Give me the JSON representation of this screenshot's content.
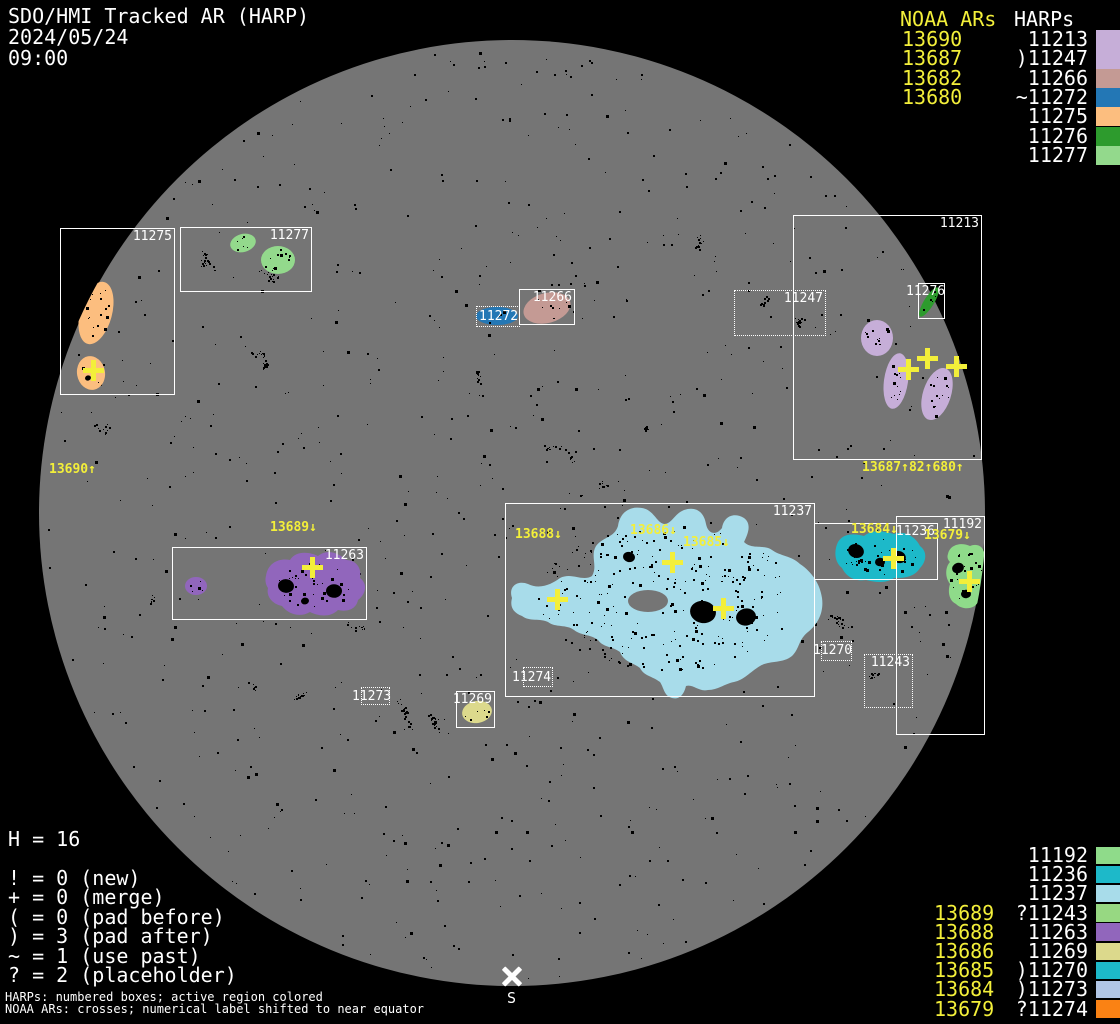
{
  "header": {
    "title": "SDO/HMI Tracked AR (HARP)",
    "date": "2024/05/24",
    "time": "09:00"
  },
  "colors": {
    "background": "#000000",
    "disk": "#757575",
    "box_stroke": "#ffffff",
    "noaa_yellow": "#f3ef3a",
    "speckle": "#000000"
  },
  "legend_top_right": {
    "noaa_header": "NOAA ARs",
    "harp_header": "HARPs",
    "rows": [
      {
        "noaa": "13690",
        "prefix": "",
        "harp": "11213",
        "color": "#c6aed8"
      },
      {
        "noaa": "13687",
        "prefix": ")",
        "harp": "11247",
        "color": "#c6aed8"
      },
      {
        "noaa": "13682",
        "prefix": "",
        "harp": "11266",
        "color": "#c49a94"
      },
      {
        "noaa": "13680",
        "prefix": "~",
        "harp": "11272",
        "color": "#2377b5"
      },
      {
        "noaa": "",
        "prefix": "",
        "harp": "11275",
        "color": "#fcbe7f"
      },
      {
        "noaa": "",
        "prefix": "",
        "harp": "11276",
        "color": "#2d9b2d"
      },
      {
        "noaa": "",
        "prefix": "",
        "harp": "11277",
        "color": "#93d98c"
      }
    ]
  },
  "legend_bottom_right": {
    "rows": [
      {
        "noaa": "",
        "prefix": "",
        "harp": "11192",
        "color": "#8fdb8a"
      },
      {
        "noaa": "",
        "prefix": "",
        "harp": "11236",
        "color": "#1db9c9"
      },
      {
        "noaa": "",
        "prefix": "",
        "harp": "11237",
        "color": "#a8dcea"
      },
      {
        "noaa": "13689",
        "prefix": "?",
        "harp": "11243",
        "color": "#97d882"
      },
      {
        "noaa": "13688",
        "prefix": "",
        "harp": "11263",
        "color": "#9166bc"
      },
      {
        "noaa": "13686",
        "prefix": "",
        "harp": "11269",
        "color": "#dcd98c"
      },
      {
        "noaa": "13685",
        "prefix": ")",
        "harp": "11270",
        "color": "#1db9c9"
      },
      {
        "noaa": "13684",
        "prefix": ")",
        "harp": "11273",
        "color": "#b1c6e6"
      },
      {
        "noaa": "13679",
        "prefix": "?",
        "harp": "11274",
        "color": "#fa8214"
      }
    ]
  },
  "legend_bottom_left": {
    "harp_count": "H = 16",
    "lines": [
      "! = 0 (new)",
      "+ = 0 (merge)",
      "( = 0 (pad before)",
      ") = 3 (pad after)",
      "~ = 1 (use past)",
      "? = 2 (placeholder)"
    ],
    "note1": "HARPs: numbered boxes; active region colored",
    "note2": "NOAA ARs: crosses; numerical label shifted to near equator"
  },
  "south_marker": {
    "label": "S",
    "x": 512,
    "y": 976
  },
  "disk": {
    "cx": 512,
    "cy": 513,
    "r": 473
  },
  "harp_boxes": [
    {
      "label": "11275",
      "x": 60,
      "y": 228,
      "w": 115,
      "h": 167,
      "style": "solid"
    },
    {
      "label": "11277",
      "x": 180,
      "y": 227,
      "w": 132,
      "h": 65,
      "style": "solid"
    },
    {
      "label": "11266",
      "x": 519,
      "y": 289,
      "w": 56,
      "h": 36,
      "style": "solid"
    },
    {
      "label": "11272",
      "x": 476,
      "y": 306,
      "w": 44,
      "h": 21,
      "style": "dotted",
      "lx": 479,
      "ly": 310
    },
    {
      "label": "11247",
      "x": 734,
      "y": 290,
      "w": 92,
      "h": 46,
      "style": "dotted"
    },
    {
      "label": "11213",
      "x": 793,
      "y": 215,
      "w": 189,
      "h": 245,
      "style": "solid"
    },
    {
      "label": "11276",
      "x": 918,
      "y": 283,
      "w": 27,
      "h": 36,
      "style": "solid",
      "lx": 906,
      "ly": 285
    },
    {
      "label": "11263",
      "x": 172,
      "y": 547,
      "w": 195,
      "h": 73,
      "style": "solid"
    },
    {
      "label": "11237",
      "x": 505,
      "y": 503,
      "w": 310,
      "h": 194,
      "style": "solid"
    },
    {
      "label": "11274",
      "x": 523,
      "y": 667,
      "w": 30,
      "h": 20,
      "style": "dotted",
      "lx": 512,
      "ly": 671
    },
    {
      "label": "11273",
      "x": 361,
      "y": 687,
      "w": 29,
      "h": 18,
      "style": "dotted",
      "lx": 352,
      "ly": 690
    },
    {
      "label": "11269",
      "x": 456,
      "y": 691,
      "w": 39,
      "h": 37,
      "style": "solid"
    },
    {
      "label": "11236",
      "x": 814,
      "y": 523,
      "w": 124,
      "h": 57,
      "style": "solid"
    },
    {
      "label": "11192",
      "x": 896,
      "y": 516,
      "w": 89,
      "h": 219,
      "style": "solid"
    },
    {
      "label": "11270",
      "x": 821,
      "y": 641,
      "w": 31,
      "h": 20,
      "style": "dotted",
      "lx": 813,
      "ly": 644
    },
    {
      "label": "11243",
      "x": 864,
      "y": 654,
      "w": 49,
      "h": 54,
      "style": "dotted"
    }
  ],
  "noaa_disk_labels": [
    {
      "text": "13690↑",
      "x": 49,
      "y": 463
    },
    {
      "text": "13687↑82↑680↑",
      "x": 862,
      "y": 461
    },
    {
      "text": "13689↓",
      "x": 270,
      "y": 521
    },
    {
      "text": "13688↓",
      "x": 515,
      "y": 528
    },
    {
      "text": "13686↓",
      "x": 630,
      "y": 524
    },
    {
      "text": "13685↓",
      "x": 683,
      "y": 536
    },
    {
      "text": "13684↓",
      "x": 851,
      "y": 523
    },
    {
      "text": "13679↓",
      "x": 924,
      "y": 529
    }
  ],
  "crosses": [
    {
      "x": 93,
      "y": 370
    },
    {
      "x": 908,
      "y": 369
    },
    {
      "x": 927,
      "y": 358
    },
    {
      "x": 956,
      "y": 366
    },
    {
      "x": 312,
      "y": 567
    },
    {
      "x": 557,
      "y": 599
    },
    {
      "x": 672,
      "y": 562
    },
    {
      "x": 723,
      "y": 608
    },
    {
      "x": 893,
      "y": 558
    },
    {
      "x": 969,
      "y": 581
    }
  ],
  "regions": [
    {
      "harp": "11275",
      "color": "#fcbe7f",
      "shape": "ellipse",
      "cx": 96,
      "cy": 313,
      "rx": 16,
      "ry": 32,
      "rot": 15,
      "speckles": 16
    },
    {
      "harp": "11275",
      "color": "#fcbe7f",
      "shape": "ellipse",
      "cx": 91,
      "cy": 373,
      "rx": 14,
      "ry": 17,
      "rot": -10,
      "speckles": 4
    },
    {
      "harp": "11277",
      "color": "#93d98c",
      "shape": "ellipse",
      "cx": 243,
      "cy": 243,
      "rx": 13,
      "ry": 9,
      "rot": -15,
      "speckles": 6
    },
    {
      "harp": "11277",
      "color": "#93d98c",
      "shape": "ellipse",
      "cx": 278,
      "cy": 260,
      "rx": 17,
      "ry": 14,
      "rot": 0,
      "speckles": 12
    },
    {
      "harp": "11266",
      "color": "#c49a94",
      "shape": "ellipse",
      "cx": 547,
      "cy": 308,
      "rx": 24,
      "ry": 15,
      "rot": -15,
      "speckles": 10
    },
    {
      "harp": "11272",
      "color": "#2377b5",
      "shape": "ellipse",
      "cx": 497,
      "cy": 316,
      "rx": 21,
      "ry": 9,
      "rot": 0,
      "speckles": 4
    },
    {
      "harp": "11276",
      "color": "#2d9b2d",
      "shape": "ellipse",
      "cx": 929,
      "cy": 302,
      "rx": 5,
      "ry": 17,
      "rot": 32,
      "speckles": 6,
      "clip": false
    },
    {
      "harp": "11213",
      "color": "#c6aed8",
      "shape": "ellipse",
      "cx": 877,
      "cy": 338,
      "rx": 16,
      "ry": 18,
      "rot": 0,
      "speckles": 12
    },
    {
      "harp": "11213",
      "color": "#c6aed8",
      "shape": "ellipse",
      "cx": 896,
      "cy": 381,
      "rx": 12,
      "ry": 28,
      "rot": 8,
      "speckles": 14
    },
    {
      "harp": "11213",
      "color": "#c6aed8",
      "shape": "ellipse",
      "cx": 937,
      "cy": 394,
      "rx": 14,
      "ry": 27,
      "rot": 18,
      "speckles": 14
    },
    {
      "harp": "11263",
      "color": "#9166bc",
      "shape": "ellipse",
      "cx": 196,
      "cy": 586,
      "rx": 11,
      "ry": 9,
      "rot": 0,
      "speckles": 5
    },
    {
      "harp": "11263",
      "color": "#9166bc",
      "shape": "path",
      "d": "M 266 576 C 268 562 280 558 290 560 C 296 550 310 552 318 556 C 328 548 340 554 346 560 C 356 560 362 568 360 578 C 368 584 366 594 358 600 C 356 610 346 612 338 610 C 330 618 318 616 310 612 C 300 618 288 614 282 606 C 272 604 266 596 268 588 C 264 582 266 576 266 576 Z",
      "cx": 312,
      "cy": 584,
      "rx": 44,
      "ry": 26,
      "speckles": 42
    },
    {
      "harp": "11237",
      "color": "#a8dcea",
      "shape": "path",
      "d": "M 512 598 C 508 586 518 580 528 584 C 540 590 552 584 560 578 C 572 572 582 582 592 576 C 598 566 590 556 596 546 C 604 536 614 538 618 526 C 620 512 630 506 642 508 C 654 510 656 522 664 524 C 672 524 674 514 684 510 C 696 506 704 512 706 524 C 708 534 716 536 722 528 C 724 516 734 512 744 518 C 752 524 748 534 744 542 C 752 550 764 544 772 550 C 780 556 792 556 800 564 C 812 572 820 584 822 598 C 824 612 818 624 808 632 C 798 640 800 648 792 656 C 782 664 770 660 760 666 C 750 672 744 680 734 682 C 724 684 718 690 708 690 C 698 692 694 684 686 686 C 684 694 680 700 672 698 C 664 696 664 688 660 682 C 652 676 644 676 640 668 C 632 662 624 662 620 652 C 612 646 604 648 598 640 C 590 634 582 636 574 630 C 566 624 556 628 548 622 C 540 618 530 622 522 616 C 512 612 510 606 512 598 Z",
      "cx": 667,
      "cy": 598,
      "rx": 148,
      "ry": 82,
      "speckles": 300,
      "hole": {
        "cx": 648,
        "cy": 601,
        "rx": 20,
        "ry": 11
      }
    },
    {
      "harp": "11236",
      "color": "#1db9c9",
      "shape": "path",
      "d": "M 838 542 C 844 532 856 534 864 536 C 874 528 886 532 894 534 C 906 530 916 538 920 546 C 928 552 926 562 920 568 C 914 578 902 578 894 578 C 886 584 874 582 866 580 C 854 582 846 576 842 568 C 834 562 834 550 838 542 Z",
      "cx": 880,
      "cy": 556,
      "rx": 42,
      "ry": 22,
      "speckles": 42
    },
    {
      "harp": "11192",
      "color": "#8fdb8a",
      "shape": "path",
      "d": "M 948 554 C 950 544 962 542 970 546 C 980 542 986 550 984 558 C 992 564 990 574 986 580 C 990 590 986 600 978 602 C 974 610 962 610 956 604 C 948 600 948 590 950 584 C 944 576 946 566 950 562 C 946 558 948 554 948 554 Z",
      "cx": 966,
      "cy": 576,
      "rx": 19,
      "ry": 29,
      "speckles": 26
    },
    {
      "harp": "11269",
      "color": "#dcd98c",
      "shape": "ellipse",
      "cx": 477,
      "cy": 712,
      "rx": 15,
      "ry": 11,
      "rot": -10,
      "speckles": 6
    }
  ],
  "dark_patches": [
    {
      "cx": 703,
      "cy": 612,
      "r": 13
    },
    {
      "cx": 746,
      "cy": 617,
      "r": 10
    },
    {
      "cx": 629,
      "cy": 557,
      "r": 6
    },
    {
      "cx": 856,
      "cy": 551,
      "r": 8
    },
    {
      "cx": 899,
      "cy": 557,
      "r": 7
    },
    {
      "cx": 880,
      "cy": 562,
      "r": 5
    },
    {
      "cx": 958,
      "cy": 568,
      "r": 6
    },
    {
      "cx": 966,
      "cy": 594,
      "r": 5
    },
    {
      "cx": 286,
      "cy": 586,
      "r": 8
    },
    {
      "cx": 334,
      "cy": 591,
      "r": 8
    },
    {
      "cx": 305,
      "cy": 601,
      "r": 4
    },
    {
      "cx": 88,
      "cy": 378,
      "r": 3
    }
  ]
}
